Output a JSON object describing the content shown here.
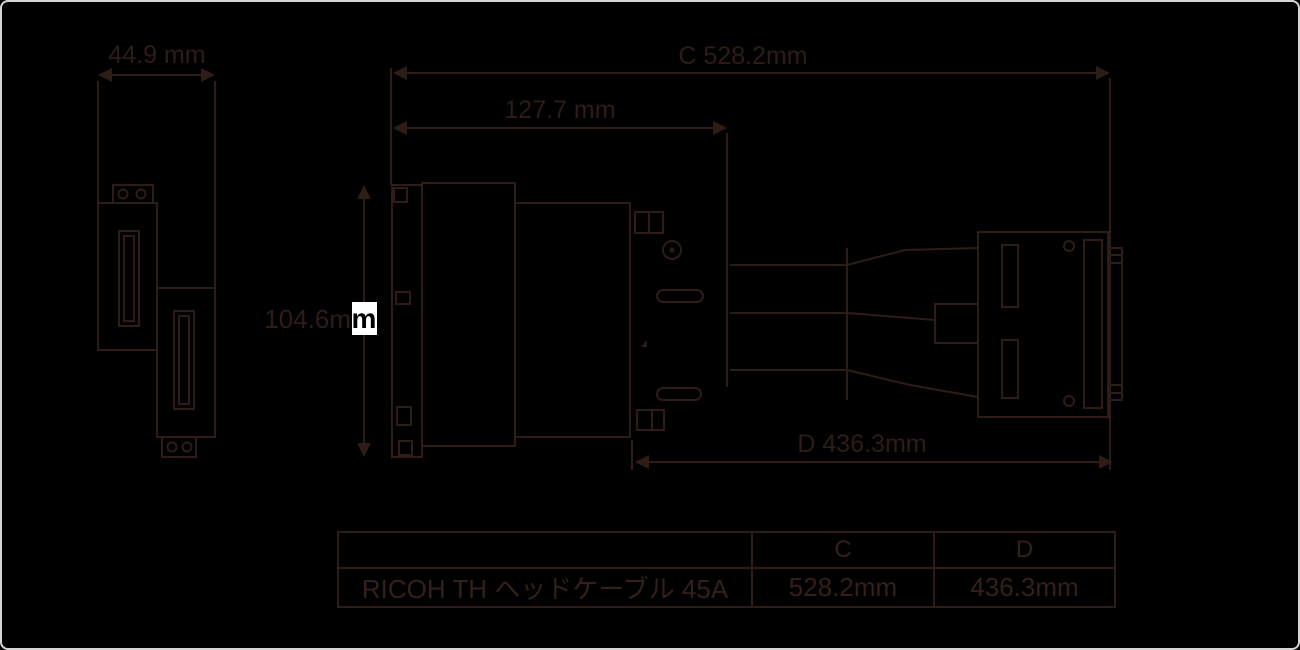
{
  "drawing": {
    "dims": {
      "width_small": "44.9 mm",
      "length_c": "C 528.2mm",
      "width_mid": "127.7 mm",
      "height_prefix": "104.6m",
      "height_highlight": "m",
      "length_d": "D 436.3mm"
    },
    "colors": {
      "background": "#000000",
      "line_art": "#2e1c16",
      "highlight_box": "#ffffff",
      "highlight_text": "#000000",
      "outer_frame": "#d5d5d5"
    }
  },
  "table": {
    "headers": [
      "",
      "C",
      "D"
    ],
    "rows": [
      [
        "RICOH TH ヘッドケーブル 45A",
        "528.2mm",
        "436.3mm"
      ]
    ]
  }
}
